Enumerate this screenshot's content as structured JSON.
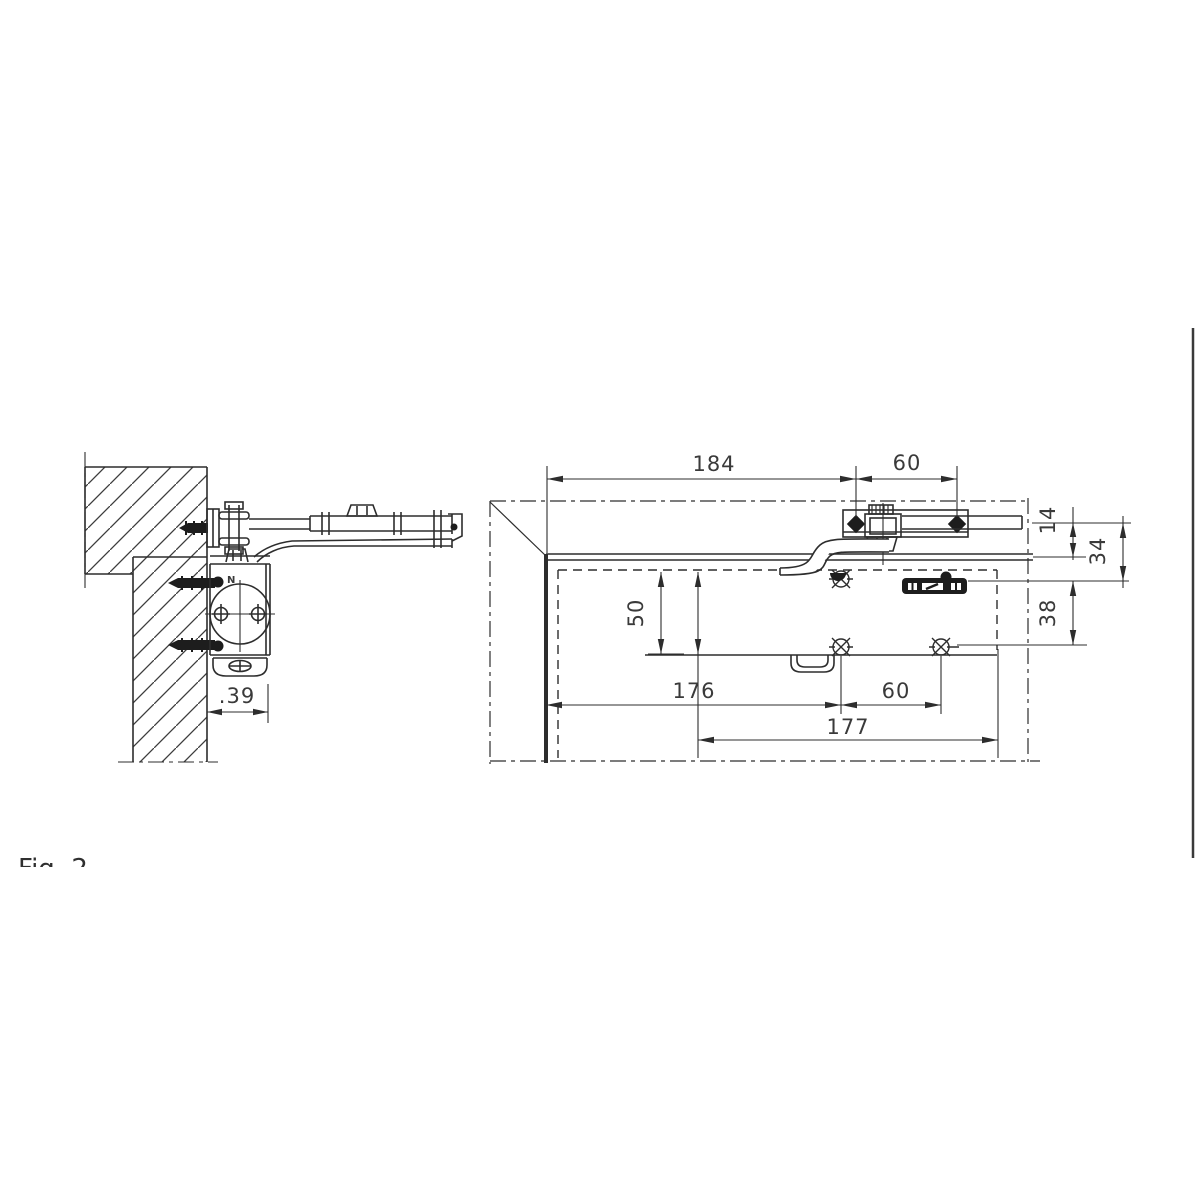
{
  "figure": {
    "caption": "Fig. 2"
  },
  "side_view": {
    "depth_dim": ".39",
    "valve_label": "N"
  },
  "plan_view": {
    "dim_total_width": "184",
    "dim_bracket_bolt_spacing": "60",
    "dim_arm_rod_to_door_top": "14",
    "dim_arm_rod_to_upper_screws": "34",
    "dim_screw_row_spacing": "38",
    "dim_body_height": "50",
    "dim_door_edge_to_screws": "176",
    "dim_screw_spacing": "60",
    "dim_mounting_length": "177"
  }
}
